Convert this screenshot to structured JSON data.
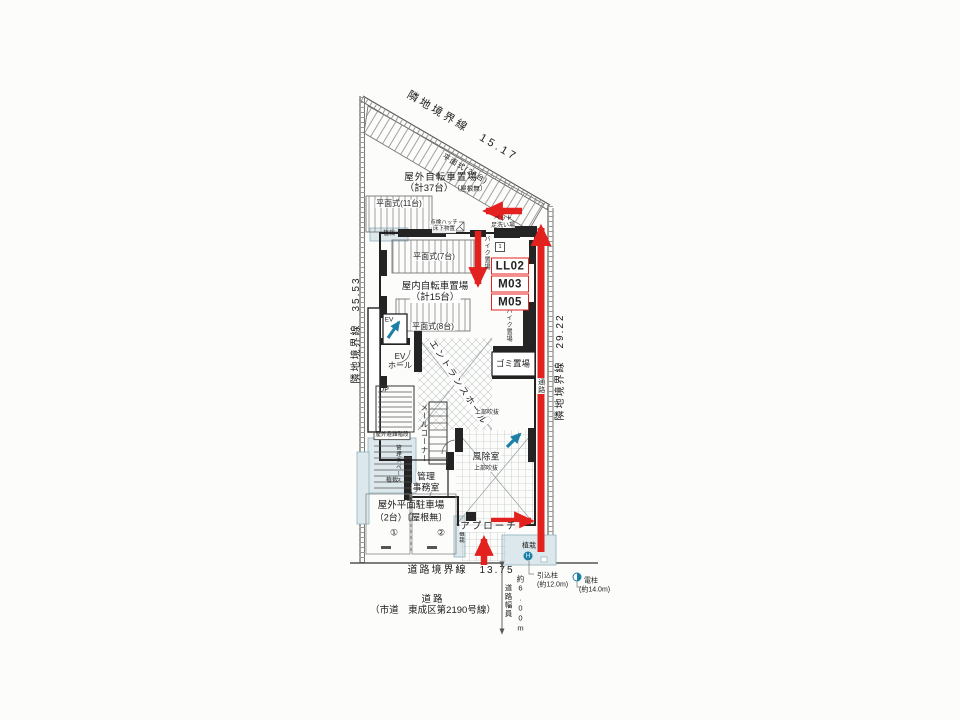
{
  "colors": {
    "red": "#e3211f",
    "blue": "#1b7fa6",
    "tint": "#dce8ec",
    "line": "#2a2a28"
  },
  "boundaries": {
    "top": "隣地境界線　15.17",
    "left": "隣地境界線　35.53",
    "right": "隣地境界線　29.22",
    "road": "道路境界線　13.75"
  },
  "outdoor_bicycle": {
    "title": "屋外自転車置場",
    "count": "（計37台）",
    "roof_note": "〔屋根無〕",
    "flat_26": "平面式(26台)",
    "flat_11": "平面式(11台)"
  },
  "indoor_bicycle": {
    "title": "屋内自転車置場",
    "count": "（計15台）",
    "flat_7": "平面式(7台)",
    "flat_8": "平面式(8台)"
  },
  "moto": {
    "bike": "バイク置場",
    "mini_bike": "ミニバイク置場",
    "chip": "1"
  },
  "pet_wash": {
    "line1": "ペット",
    "line2": "足洗い場"
  },
  "hatch_note": {
    "line1": "点検ハッチ",
    "line2": "床下物置"
  },
  "units": [
    "LL02",
    "M03",
    "M05"
  ],
  "rooms": {
    "ev": "EV",
    "ev_hall_line1": "EV",
    "ev_hall_line2": "ホール",
    "up": "UP",
    "entrance_hall": "エントランスホール",
    "garbage": "ゴミ置場",
    "corridor": "通路",
    "mail_corner": "メールコーナー",
    "void_upper": "上部吹抜",
    "windbreak": "風除室",
    "void_lower": "上部吹抜",
    "office_line1": "管理",
    "office_line2": "事務室",
    "escape_stair": "屋外避難階段",
    "stair_space": "管理スペース"
  },
  "planting": {
    "p1": "植栽",
    "p2": "植栽",
    "p3": "植栽",
    "p4": "植栽"
  },
  "parking": {
    "title": "屋外平面駐車場",
    "count": "（2台）〔屋根無〕",
    "stall_1": "①",
    "stall_2": "②"
  },
  "approach": "アプローチ",
  "road": {
    "name_line1": "道路",
    "name_line2": "（市道　東成区第2190号線）",
    "width_label": "道路幅員",
    "width_value": "約6.00m"
  },
  "poles": {
    "service": "引込柱",
    "service_height": "(約12.0m)",
    "utility": "電柱",
    "utility_height": "(約14.0m)",
    "h_symbol": "H"
  }
}
